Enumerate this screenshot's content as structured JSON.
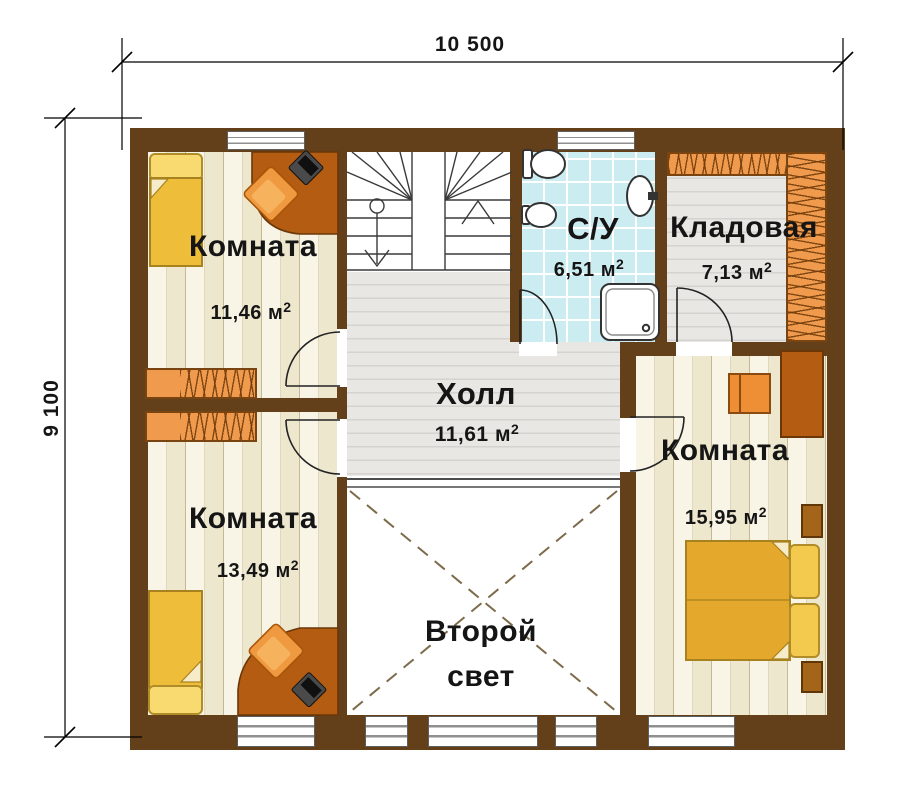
{
  "dimensions": {
    "top_width_label": "10 500",
    "left_height_label": "9 100"
  },
  "rooms": {
    "bedroom_top_left": {
      "label": "Комната",
      "area": "11,46 м",
      "area_sup": "2"
    },
    "bedroom_bottom_left": {
      "label": "Комната",
      "area": "13,49 м",
      "area_sup": "2"
    },
    "bedroom_right": {
      "label": "Комната",
      "area": "15,95 м",
      "area_sup": "2"
    },
    "bathroom": {
      "label": "С/У",
      "area": "6,51 м",
      "area_sup": "2"
    },
    "storage": {
      "label": "Кладовая",
      "area": "7,13 м",
      "area_sup": "2"
    },
    "hall": {
      "label": "Холл",
      "area": "11,61 м",
      "area_sup": "2"
    },
    "void": {
      "label_line1": "Второй",
      "label_line2": "свет"
    }
  },
  "colors": {
    "wall_brown": "#63401a",
    "plank_floor_cream": "#f6efd6",
    "hall_floor_gray": "#e8e7e4",
    "bathroom_floor_cyan": "#cbedf2",
    "void_white": "#ffffff",
    "furniture_orange": "#f09a4d",
    "desk_brown": "#b35c12",
    "bed_yellow": "#eebd39",
    "pillow_yellow": "#f8da71"
  }
}
